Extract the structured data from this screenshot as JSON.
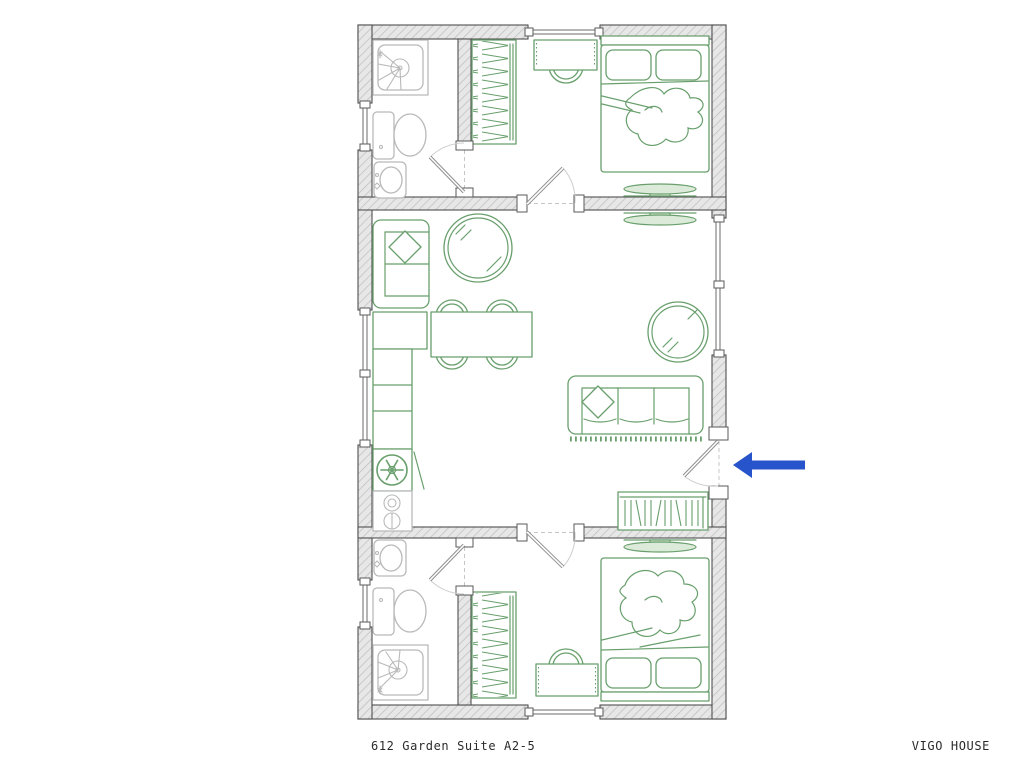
{
  "canvas": {
    "width": 1024,
    "height": 768,
    "background": "#ffffff"
  },
  "footer": {
    "left_label": "612 Garden Suite A2-5",
    "right_label": "VIGO HOUSE"
  },
  "colors": {
    "wall_fill": "#e7e7e7",
    "wall_hatch": "#bdbdbd",
    "wall_outline": "#4f4f4f",
    "furniture_green": "#689f6c",
    "furniture_green_fill": "#dcead9",
    "fixture_gray": "#b9b9b9",
    "dash_gray": "#c6c6c6",
    "arrow_blue": "#2754cb",
    "text_color": "#2b2b2b"
  },
  "plan": {
    "drawing_type": "floor-plan",
    "rooms": [
      {
        "name": "bedroom-top",
        "furniture": [
          "wardrobe",
          "desk",
          "desk-chair",
          "double-bed",
          "tv"
        ]
      },
      {
        "name": "bathroom-top",
        "furniture": [
          "shower",
          "toilet",
          "sink"
        ]
      },
      {
        "name": "living-kitchen",
        "furniture": [
          "two-seat-sofa",
          "round-rug",
          "dining-table",
          "dining-chairs",
          "kitchen-counter",
          "fridge-freezer",
          "cooktop",
          "tv",
          "three-seat-sofa",
          "round-rug",
          "bookshelf"
        ]
      },
      {
        "name": "bedroom-bottom",
        "furniture": [
          "wardrobe",
          "desk",
          "desk-chair",
          "double-bed",
          "tv"
        ]
      },
      {
        "name": "bathroom-bottom",
        "furniture": [
          "sink",
          "toilet",
          "shower"
        ]
      }
    ],
    "openings": {
      "windows": [
        "top-wall",
        "bottom-wall",
        "left-wall-top",
        "left-wall-middle",
        "left-wall-bottom",
        "right-wall-living"
      ],
      "doors": [
        "bathroom-top-door",
        "bedroom-top-door",
        "bedroom-bottom-door",
        "bathroom-bottom-door",
        "entrance-door"
      ]
    },
    "entrance_marker": {
      "icon": "blue-arrow",
      "direction": "left",
      "location": "right-wall-entrance-door"
    }
  }
}
